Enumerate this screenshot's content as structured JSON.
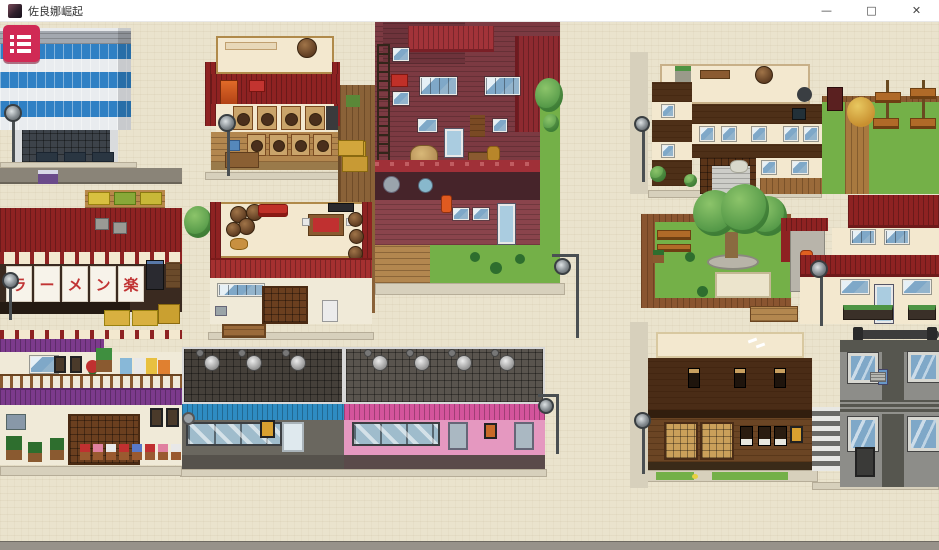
{
  "window": {
    "title": "佐良娜崛起",
    "controls": {
      "minimize": "—",
      "maximize": "□",
      "close": "✕"
    }
  },
  "hud": {
    "menu_button": {
      "icon": "menu-list-icon"
    }
  },
  "signs": {
    "ramen_noren_chars": [
      "ラ",
      "ー",
      "メ",
      "ン",
      "楽"
    ]
  },
  "colors": {
    "ground": "#eae3cd",
    "sidewalk": "#d7d0bc",
    "roof_red": "#8e2222",
    "roof_red_bright": "#a53030",
    "brick": "#7c3a42",
    "brick_light": "#8a444c",
    "cream": "#f3e8cf",
    "white_wall": "#f0ead8",
    "window_blue": "#7fa8c8",
    "blue_band": "#2f80c4",
    "bldg_white": "#e9ecef",
    "roof_gray": "#a3a8af",
    "purple": "#7c3a8c",
    "wood": "#b3874f",
    "wood_dark": "#6b4524",
    "izakaya_dark": "#4a2c16",
    "dark_roof_left": "#45403a",
    "dark_roof_right": "#59544e",
    "awning_blue": "#2e8cc2",
    "awning_pink": "#d4549c",
    "grass": "#74b048",
    "tree_green": "#4e9444",
    "lamp_metal": "#4a4f52",
    "menu_crimson": "#d02a55",
    "noren_red": "#c13434",
    "concrete": "#8d8d89",
    "concrete_dark": "#56564f"
  },
  "map": {
    "features": [
      {
        "name": "modern-blue-building",
        "type": "building"
      },
      {
        "name": "sake-shop",
        "type": "building"
      },
      {
        "name": "red-brick-building",
        "type": "building"
      },
      {
        "name": "wooden-fence-strip",
        "type": "fence"
      },
      {
        "name": "ramen-shop",
        "type": "building"
      },
      {
        "name": "family-restaurant",
        "type": "building"
      },
      {
        "name": "purple-roof-rowhouse",
        "type": "building"
      },
      {
        "name": "store-blue-awning",
        "type": "building"
      },
      {
        "name": "store-pink-awning",
        "type": "building"
      },
      {
        "name": "brown-inn-building",
        "type": "building"
      },
      {
        "name": "rooftop-garden",
        "type": "park"
      },
      {
        "name": "public-park-big-tree",
        "type": "park"
      },
      {
        "name": "red-roof-restaurant",
        "type": "building"
      },
      {
        "name": "izakaya",
        "type": "building"
      },
      {
        "name": "modern-gray-building",
        "type": "building"
      },
      {
        "name": "street-lamps",
        "type": "prop",
        "count": 8
      }
    ]
  }
}
